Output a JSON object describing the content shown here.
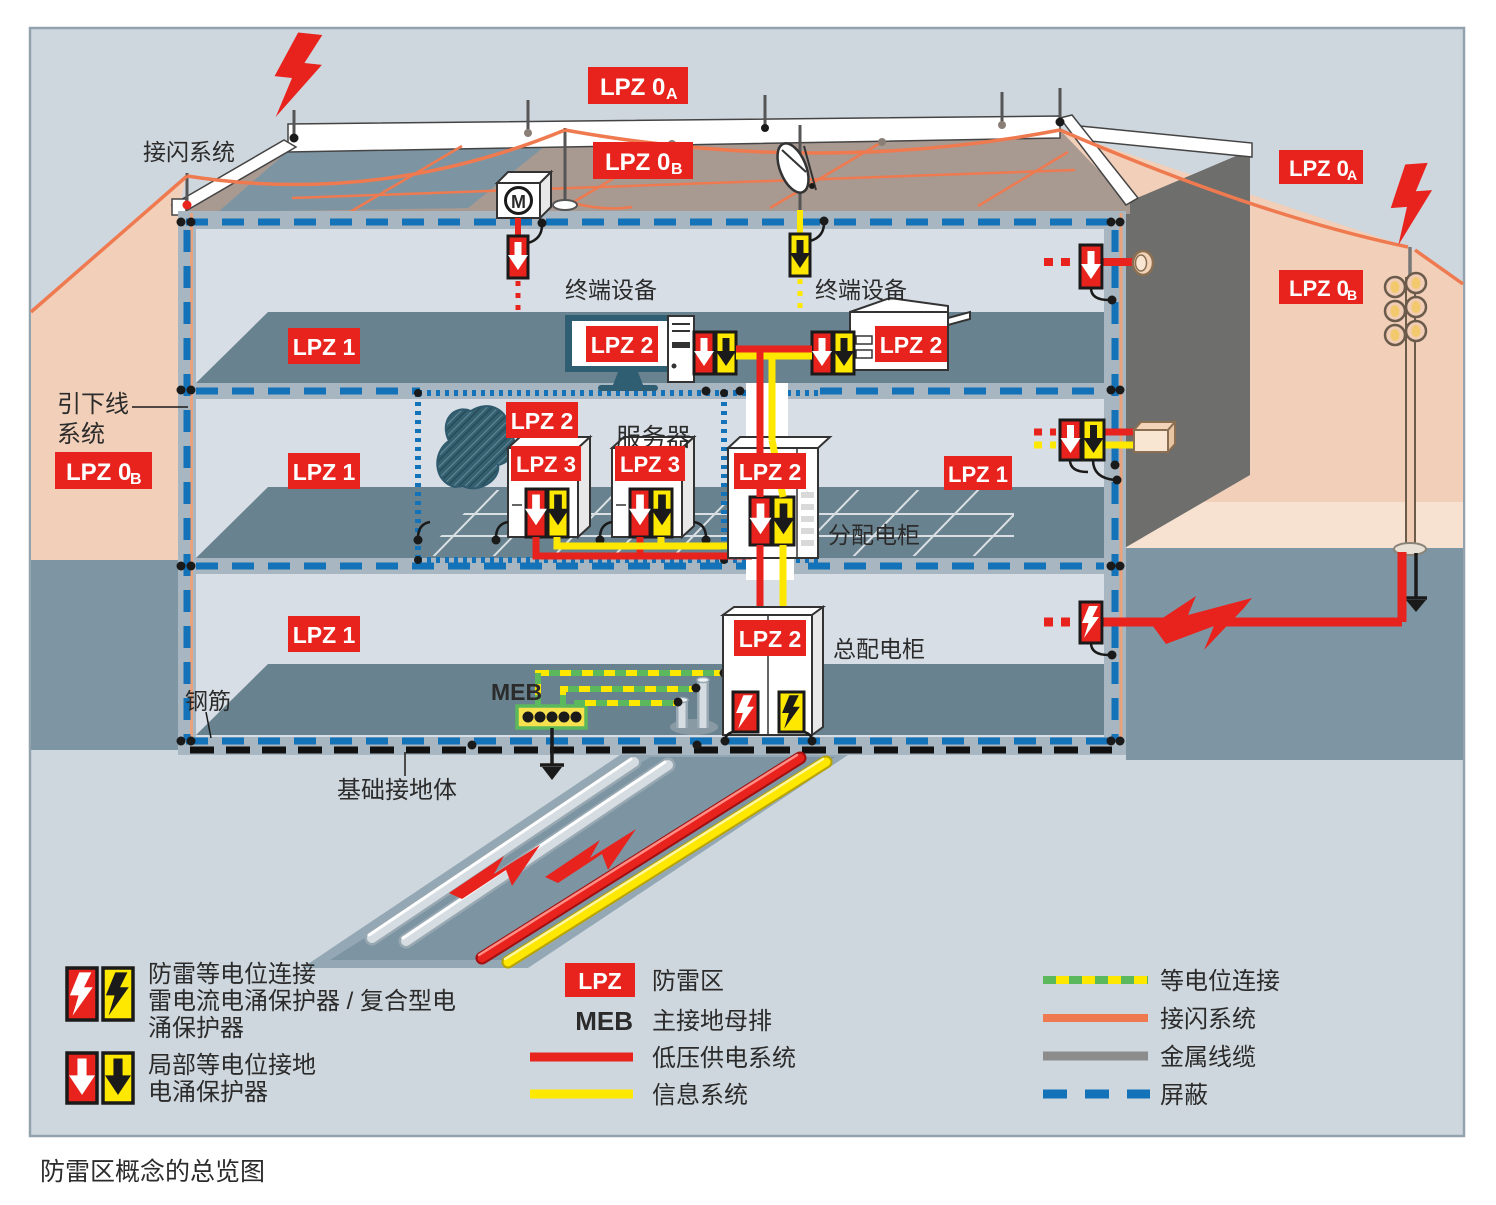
{
  "caption": "防雷区概念的总览图",
  "colors": {
    "red": "#e8231e",
    "yellow": "#ffe800",
    "orange": "#ef7a50",
    "shield_blue": "#1472b8",
    "bonding_green": "#5cb85c",
    "salmon": "#f2cfb8",
    "panel_bg": "#cfd7de",
    "slab_dark": "#69828f",
    "ground": "#7e96a4",
    "roof": "#a89991",
    "metal_gray": "#8c8c8c"
  },
  "zones": {
    "lpz0_main": "LPZ 0",
    "sub_a": "A",
    "sub_b": "B",
    "lpz1": "LPZ 1",
    "lpz2": "LPZ 2",
    "lpz3": "LPZ 3"
  },
  "labels": {
    "air_termination": "接闪系统",
    "down_conductor_line1": "引下线",
    "down_conductor_line2": "系统",
    "terminal_left": "终端设备",
    "terminal_right": "终端设备",
    "server": "服务器",
    "distribution_cabinet": "分配电柜",
    "main_cabinet": "总配电柜",
    "meb": "MEB",
    "rebar": "钢筋",
    "foundation_earth": "基础接地体",
    "motor": "M"
  },
  "legend": {
    "spd1_line1": "防雷等电位连接",
    "spd1_line2": "雷电流电涌保护器 / 复合型电",
    "spd1_line3": "涌保护器",
    "spd2_line1": "局部等电位接地",
    "spd2_line2": "电涌保护器",
    "lpz_badge": "LPZ",
    "lpz_desc": "防雷区",
    "meb_abbr": "MEB",
    "meb_desc": "主接地母排",
    "lv_desc": "低压供电系统",
    "info_desc": "信息系统",
    "bonding_desc": "等电位连接",
    "air_term_desc": "接闪系统",
    "metal_desc": "金属线缆",
    "shield_desc": "屏蔽"
  }
}
